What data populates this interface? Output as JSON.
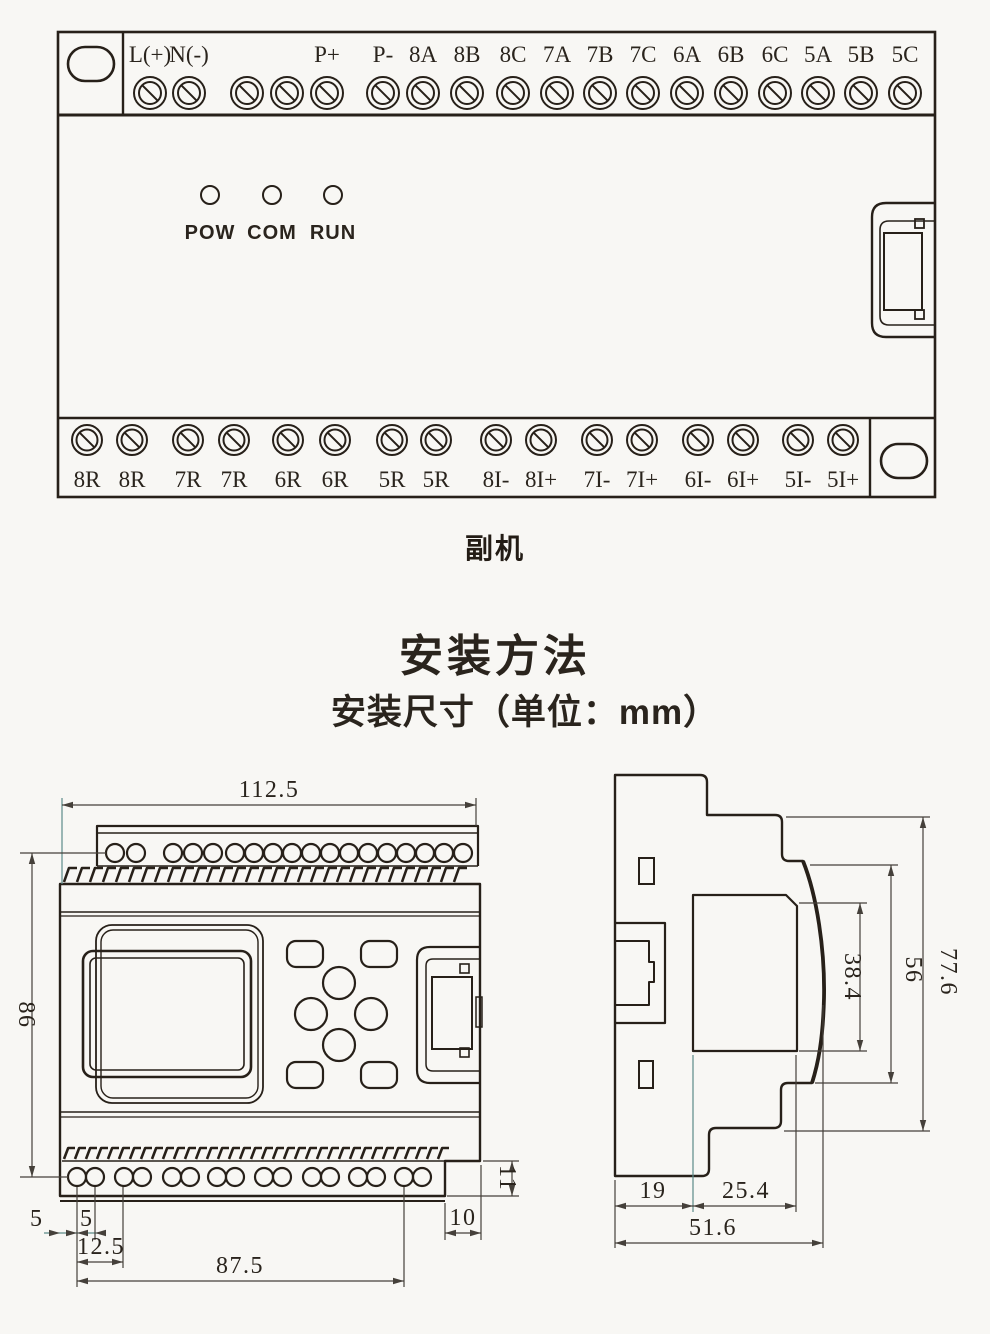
{
  "page": {
    "background": "#f8f7f4",
    "ink": "#272019",
    "dim_ink": "#45403a",
    "accent_teal": "#5b8a88"
  },
  "device": {
    "caption": "副机",
    "top_terminals": [
      {
        "label": "L(+)",
        "x": 150
      },
      {
        "label": "N(-)",
        "x": 189
      },
      {
        "label": "",
        "x": 247
      },
      {
        "label": "",
        "x": 287
      },
      {
        "label": "P+",
        "x": 327
      },
      {
        "label": "P-",
        "x": 383
      },
      {
        "label": "8A",
        "x": 423
      },
      {
        "label": "8B",
        "x": 467
      },
      {
        "label": "8C",
        "x": 513
      },
      {
        "label": "7A",
        "x": 557
      },
      {
        "label": "7B",
        "x": 600
      },
      {
        "label": "7C",
        "x": 643
      },
      {
        "label": "6A",
        "x": 687
      },
      {
        "label": "6B",
        "x": 731
      },
      {
        "label": "6C",
        "x": 775
      },
      {
        "label": "5A",
        "x": 818
      },
      {
        "label": "5B",
        "x": 861
      },
      {
        "label": "5C",
        "x": 905
      }
    ],
    "leds": [
      {
        "label": "POW",
        "x": 210
      },
      {
        "label": "COM",
        "x": 272
      },
      {
        "label": "RUN",
        "x": 333
      }
    ],
    "bottom_terminals": [
      {
        "label": "8R",
        "x": 87
      },
      {
        "label": "8R",
        "x": 132
      },
      {
        "label": "7R",
        "x": 188
      },
      {
        "label": "7R",
        "x": 234
      },
      {
        "label": "6R",
        "x": 288
      },
      {
        "label": "6R",
        "x": 335
      },
      {
        "label": "5R",
        "x": 392
      },
      {
        "label": "5R",
        "x": 436
      },
      {
        "label": "8I-",
        "x": 496
      },
      {
        "label": "8I+",
        "x": 541
      },
      {
        "label": "7I-",
        "x": 597
      },
      {
        "label": "7I+",
        "x": 642
      },
      {
        "label": "6I-",
        "x": 698
      },
      {
        "label": "6I+",
        "x": 743
      },
      {
        "label": "5I-",
        "x": 798
      },
      {
        "label": "5I+",
        "x": 843
      }
    ]
  },
  "headings": {
    "method_title": "安装方法",
    "dimension_subtitle": "安装尺寸（单位：mm）"
  },
  "front_view": {
    "dim_width": "112.5",
    "dim_height": "86",
    "dim_left_5a": "5",
    "dim_left_5b": "5",
    "dim_12_5": "12.5",
    "dim_87_5": "87.5",
    "dim_10": "10",
    "dim_11": "11"
  },
  "side_view": {
    "dim_77_6": "77.6",
    "dim_56": "56",
    "dim_38_4": "38.4",
    "dim_19": "19",
    "dim_25_4": "25.4",
    "dim_51_6": "51.6"
  }
}
